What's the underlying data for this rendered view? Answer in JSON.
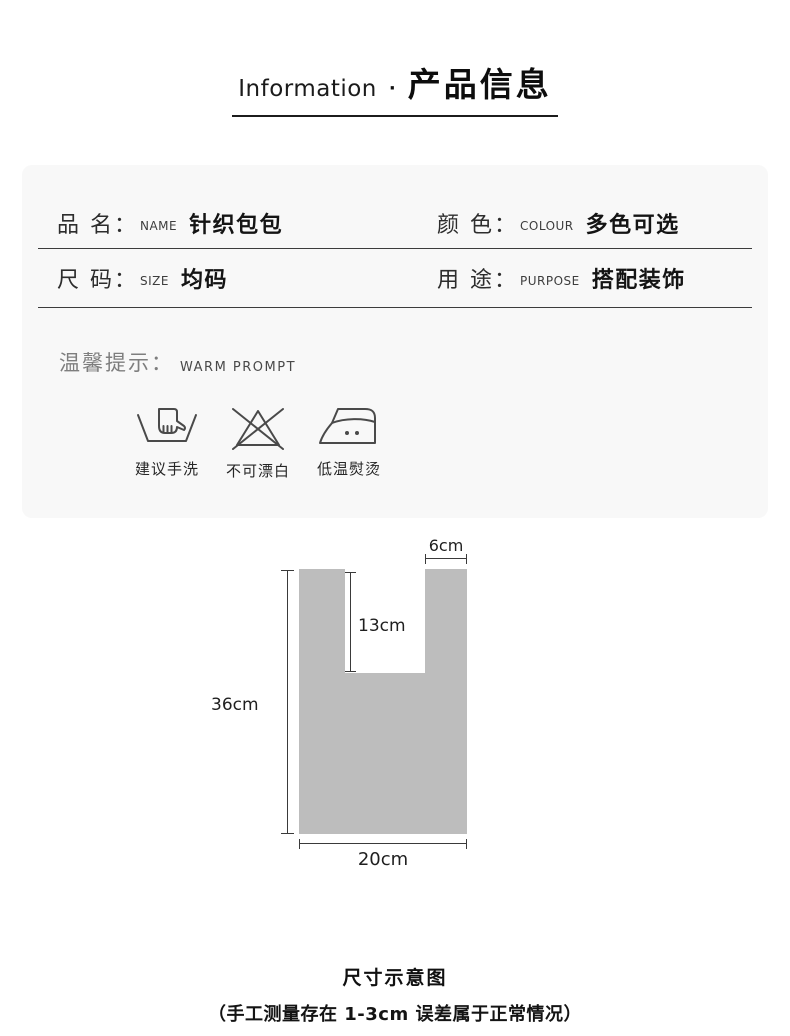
{
  "header": {
    "en": "Information",
    "dot": "·",
    "zh": "产品信息"
  },
  "info": {
    "rows": [
      [
        {
          "label": "品 名：",
          "en": "NAME",
          "value": "针织包包"
        },
        {
          "label": "颜 色：",
          "en": "COLOUR",
          "value": "多色可选"
        }
      ],
      [
        {
          "label": "尺 码：",
          "en": "SIZE",
          "value": "均码"
        },
        {
          "label": "用 途：",
          "en": "PURPOSE",
          "value": "搭配装饰"
        }
      ]
    ]
  },
  "warm": {
    "zh": "温馨提示：",
    "en": "WARM PROMPT",
    "icons": [
      {
        "icon": "hand-wash-icon",
        "label": "建议手洗"
      },
      {
        "icon": "no-bleach-icon",
        "label": "不可漂白"
      },
      {
        "icon": "iron-low-temp-icon",
        "label": "低温熨烫"
      }
    ]
  },
  "diagram": {
    "type": "size-diagram",
    "shape": "tote-bag-silhouette",
    "bag_fill": "#bdbdbd",
    "dimensions": {
      "strap_width": "6cm",
      "handle_depth": "13cm",
      "bag_height": "36cm",
      "bag_width": "20cm"
    }
  },
  "footer": {
    "title": "尺寸示意图",
    "note": "（手工测量存在 1-3cm 误差属于正常情况）"
  },
  "colors": {
    "page_bg": "#ffffff",
    "card_bg": "#f8f8f8",
    "rule": "#3c3c3c",
    "bag_fill": "#bdbdbd",
    "text_dark": "#141414",
    "text_gray": "#7e7e7e"
  }
}
